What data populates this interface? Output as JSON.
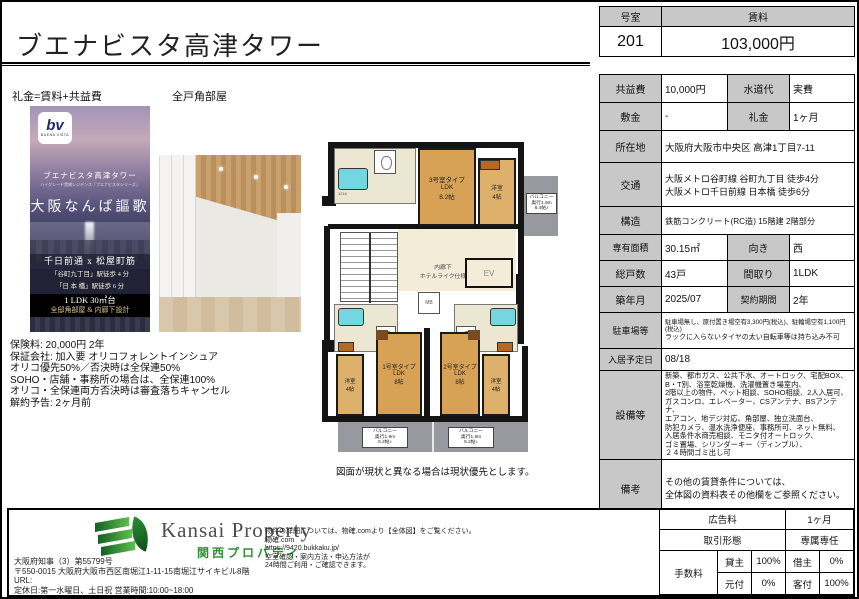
{
  "page": {
    "title": "ブエナビスタ高津タワー",
    "floorplan_caption": "図面が現状と異なる場合は現状優先とします。"
  },
  "header": {
    "room_label": "号室",
    "room_value": "201",
    "rent_label": "賃料",
    "rent_value": "103,000円"
  },
  "left": {
    "reikin_note": "礼金=賃料+共益費",
    "corner_note": "全戸角部屋",
    "poster": {
      "logo_text": "bv",
      "logo_sub": "BUENA VISTA",
      "building_name": "ブエナビスタ高津タワー",
      "subtitle": "ハイグレード賃貸レジデンス「ブエナビスタシリーズ」",
      "catchcopy": "大阪なんば謳歌",
      "streets": "千日前通 x 松屋町筋",
      "access1": "「谷町九丁目」駅徒歩 4 分",
      "access2": "「日 本 橋」駅徒歩 6 分",
      "spec1": "1 LDK 30㎡台",
      "spec2": "全邸角部屋 & 内廊下設計"
    },
    "terms_lines": [
      "保険料: 20,000円 2年",
      "保証会社: 加入要 オリコフォレントインシュア",
      "オリコ優先50%／否決時は全保連50%",
      "SOHO・店舗・事務所の場合は、全保連100%",
      "オリコ・全保連両方否決時は審査落ちキャンセル",
      "解約予告: 2ヶ月前"
    ]
  },
  "floorplan": {
    "unit3_label": "3号室タイプ\nLDK\n8.2帖",
    "unit1_label": "1号室タイプ\nLDK\n8帖",
    "unit2_label": "2号室タイプ\nLDK\n8帖",
    "yoshitsu_top": "洋室\n4帖",
    "yoshitsu_left": "洋室\n4帖",
    "yoshitsu_right": "洋室\n4帖",
    "balcony_right": "バルコニー\n奥行1.9m\n6.4帖♪",
    "balcony_bottom1": "バルコニー\n奥行1.9m\n5.2帖♪",
    "balcony_bottom2": "バルコニー\n奥行1.9m\n5.2帖♪",
    "corridor_label": "内廊下\nホテルライク仕様",
    "elevator_label": "EV",
    "mb_label": "MB",
    "tub_label": "1216"
  },
  "details": {
    "kyoekihi_label": "共益費",
    "kyoekihi": "10,000円",
    "suidodai_label": "水道代",
    "suidodai": "実費",
    "shikikin_label": "敷金",
    "shikikin": "-",
    "reikin_label": "礼金",
    "reikin": "1ヶ月",
    "shozaichi_label": "所在地",
    "shozaichi": "大阪府大阪市中央区 高津1丁目7-11",
    "kotsu_label": "交通",
    "kotsu1": "大阪メトロ谷町線 谷町九丁目 徒歩4分",
    "kotsu2": "大阪メトロ千日前線 日本橋 徒歩6分",
    "kozo_label": "構造",
    "kozo": "鉄筋コンクリート(RC造) 15階建 2階部分",
    "menseki_label": "専有面積",
    "menseki": "30.15㎡",
    "muki_label": "向き",
    "muki": "西",
    "kosu_label": "総戸数",
    "kosu": "43戸",
    "madori_label": "間取り",
    "madori": "1LDK",
    "chikunengetsu_label": "築年月",
    "chikunengetsu": "2025/07",
    "keiyaku_label": "契約期間",
    "keiyaku": "2年",
    "parking_label": "駐車場等",
    "parking1": "駐車場無し、原付置き場空有3,300円(税込)、駐輪場空有1,100円(税込)",
    "parking2": "ラックに入らないタイヤの太い自転車等は持ち込み不可",
    "nyukyo_label": "入居予定日",
    "nyukyo": "08/18",
    "setsubi_label": "設備等",
    "setsubi_lines": [
      "新築、都市ガス、公共下水、オートロック、宅配BOX、",
      "B・T別、浴室乾燥機、洗濯機置き場室内、",
      "2階以上の物件、ペット相談、SOHO相談、2人入居可、",
      "ガスコンロ、エレベーター、CSアンテナ、BSアンテナ、",
      "エアコン、地デジ対応、角部屋、独立洗面台、",
      "防犯カメラ、温水洗浄便座、事務所可、ネット無料、",
      "入居条件水商売相談、モニタ付オートロック、",
      "ゴミ置場、シリンダーキー（ディンプル）、",
      "２４時間ゴミ出し可"
    ],
    "biko_label": "備考",
    "biko1": "その他の賃貸条件については、",
    "biko2": "全体図の資料表その他欄をご参照ください。"
  },
  "footer": {
    "company": {
      "name_en": "Kansai Property",
      "name_jp": "関西プロパティ",
      "license": "大阪府知事（3）第55799号",
      "address": "〒550-0015 大阪府大阪市西区南堀江1-11-15南堀江サイキビル8階",
      "url_label": "URL:",
      "hours": "定休日:第一水曜日、土日祝 営業時間:10:00~18:00"
    },
    "notice_lines": [
      "物件の詳細については、物確.comより【全体図】をご覧ください。",
      "物確.com",
      "https://9420.bukkaku.jp/",
      "空室確認・案内方法・申込方法が",
      "24時間ご利用・ご確認できます。"
    ],
    "fee": {
      "ad_label": "広告料",
      "ad_value": "1ヶ月",
      "deal_label": "取引形態",
      "deal_value": "専属専任",
      "fee_label": "手数料",
      "c1": "貸主",
      "v1": "100%",
      "c2": "借主",
      "v2": "0%",
      "c3": "元付",
      "v3": "0%",
      "c4": "客付",
      "v4": "100%"
    }
  }
}
